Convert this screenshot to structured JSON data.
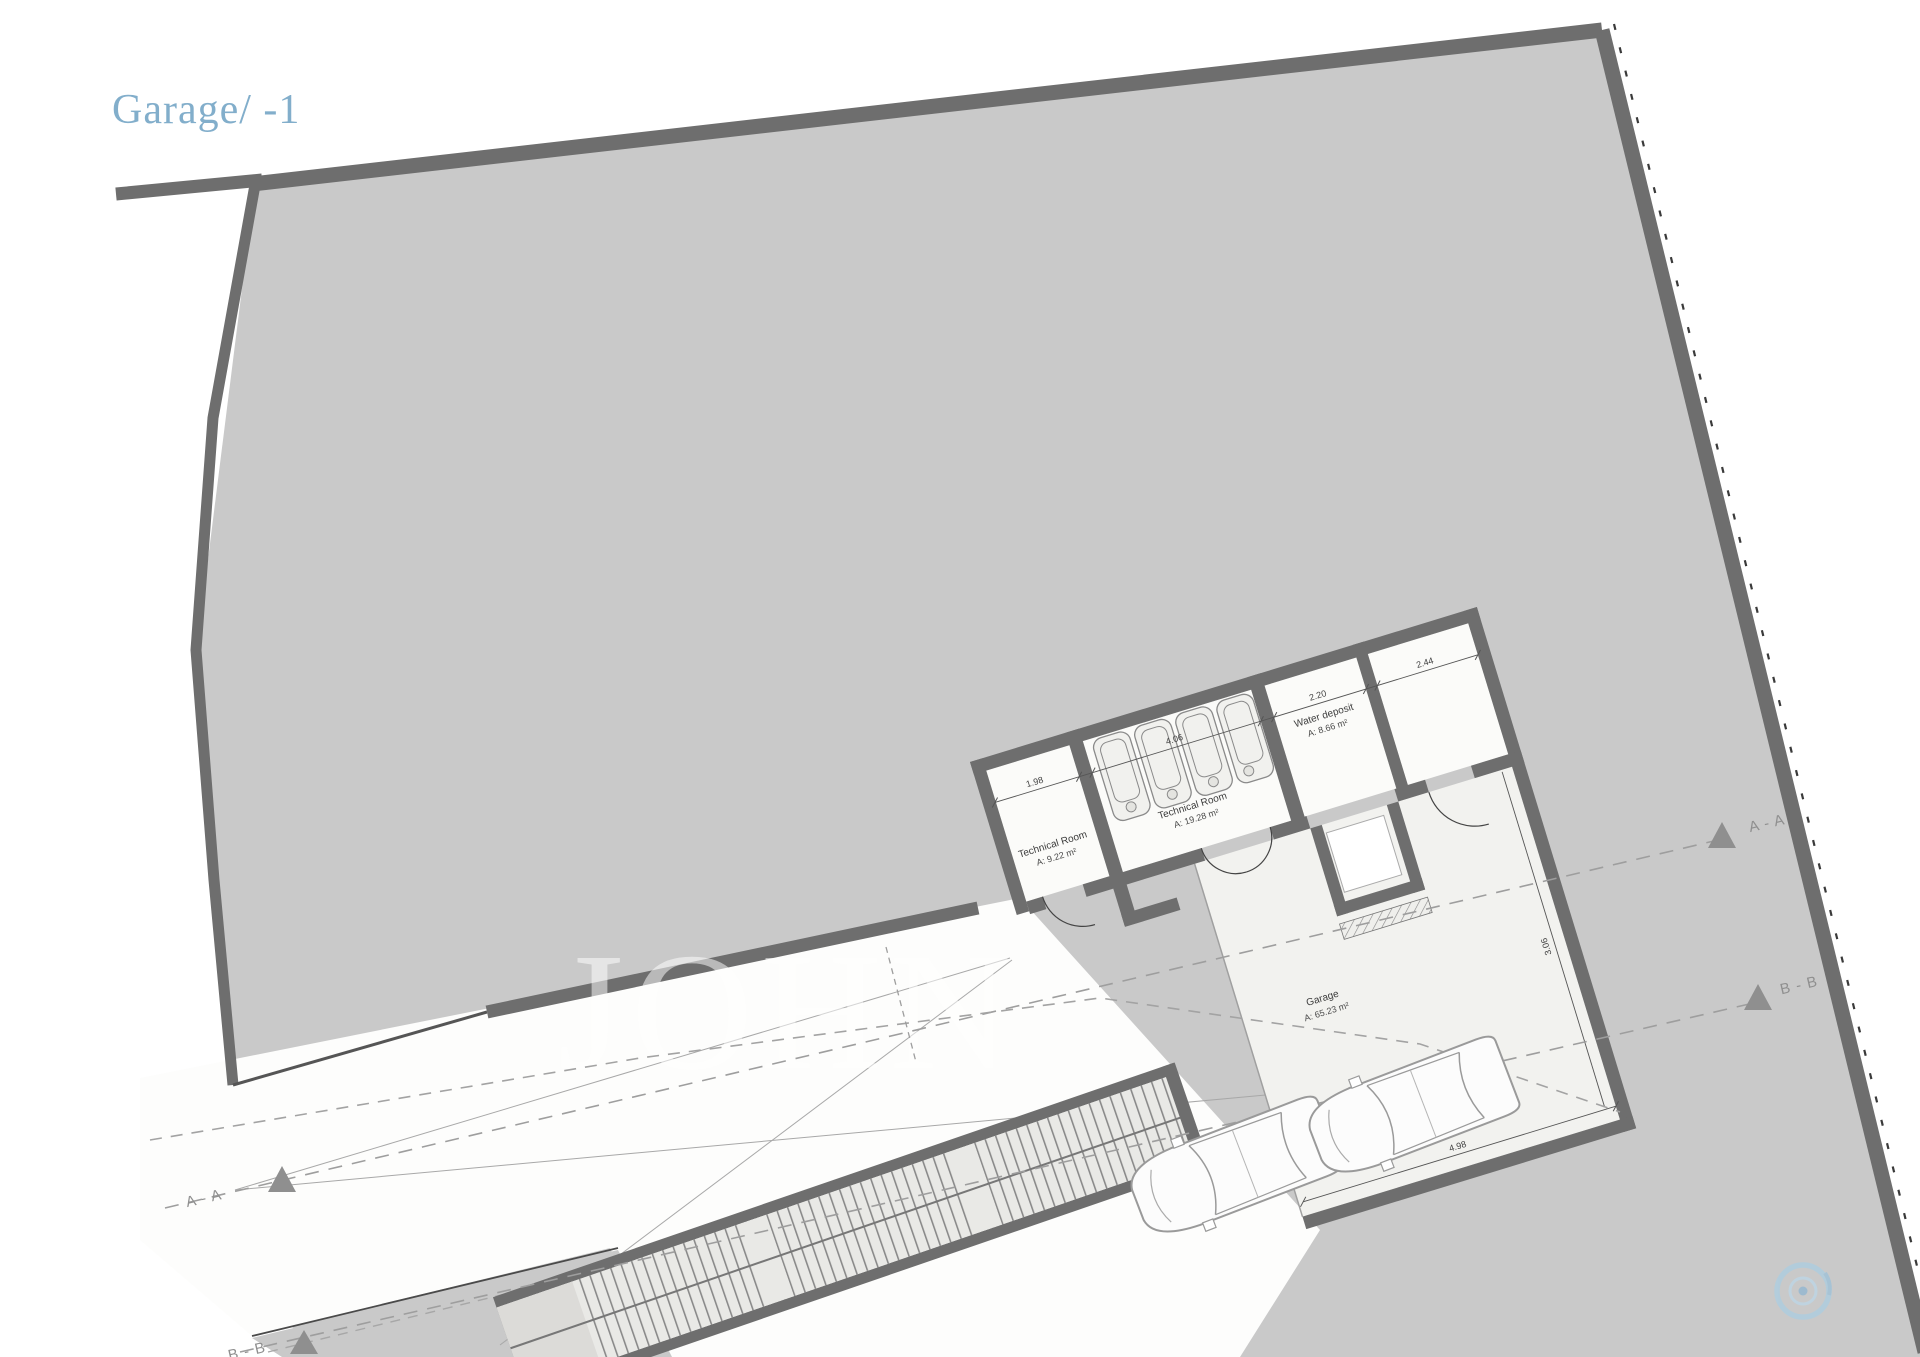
{
  "title": "Garage/ -1",
  "watermark": "JOHN",
  "rooms": {
    "tech1": {
      "name": "Technical Room",
      "area": "A:  9.22 m²"
    },
    "tech2": {
      "name": "Technical Room",
      "area": "A:  19.28 m²"
    },
    "water": {
      "name": "Water deposit",
      "area": "A:  8.66 m²"
    },
    "garage": {
      "name": "Garage",
      "area": "A: 65.23 m²"
    }
  },
  "sections": {
    "aa": "A - A",
    "bb": "B - B"
  },
  "dims": [
    "1.98",
    "4.06",
    "2.20",
    "2.44",
    "4.98",
    "3.06"
  ],
  "colors": {
    "site_gray": "#c9c9c9",
    "wall_gray": "#6e6e6e",
    "title_blue": "#82aecb",
    "compass_blue": "#abcde1"
  },
  "icons": {
    "bottom_right": "compass-icon"
  }
}
